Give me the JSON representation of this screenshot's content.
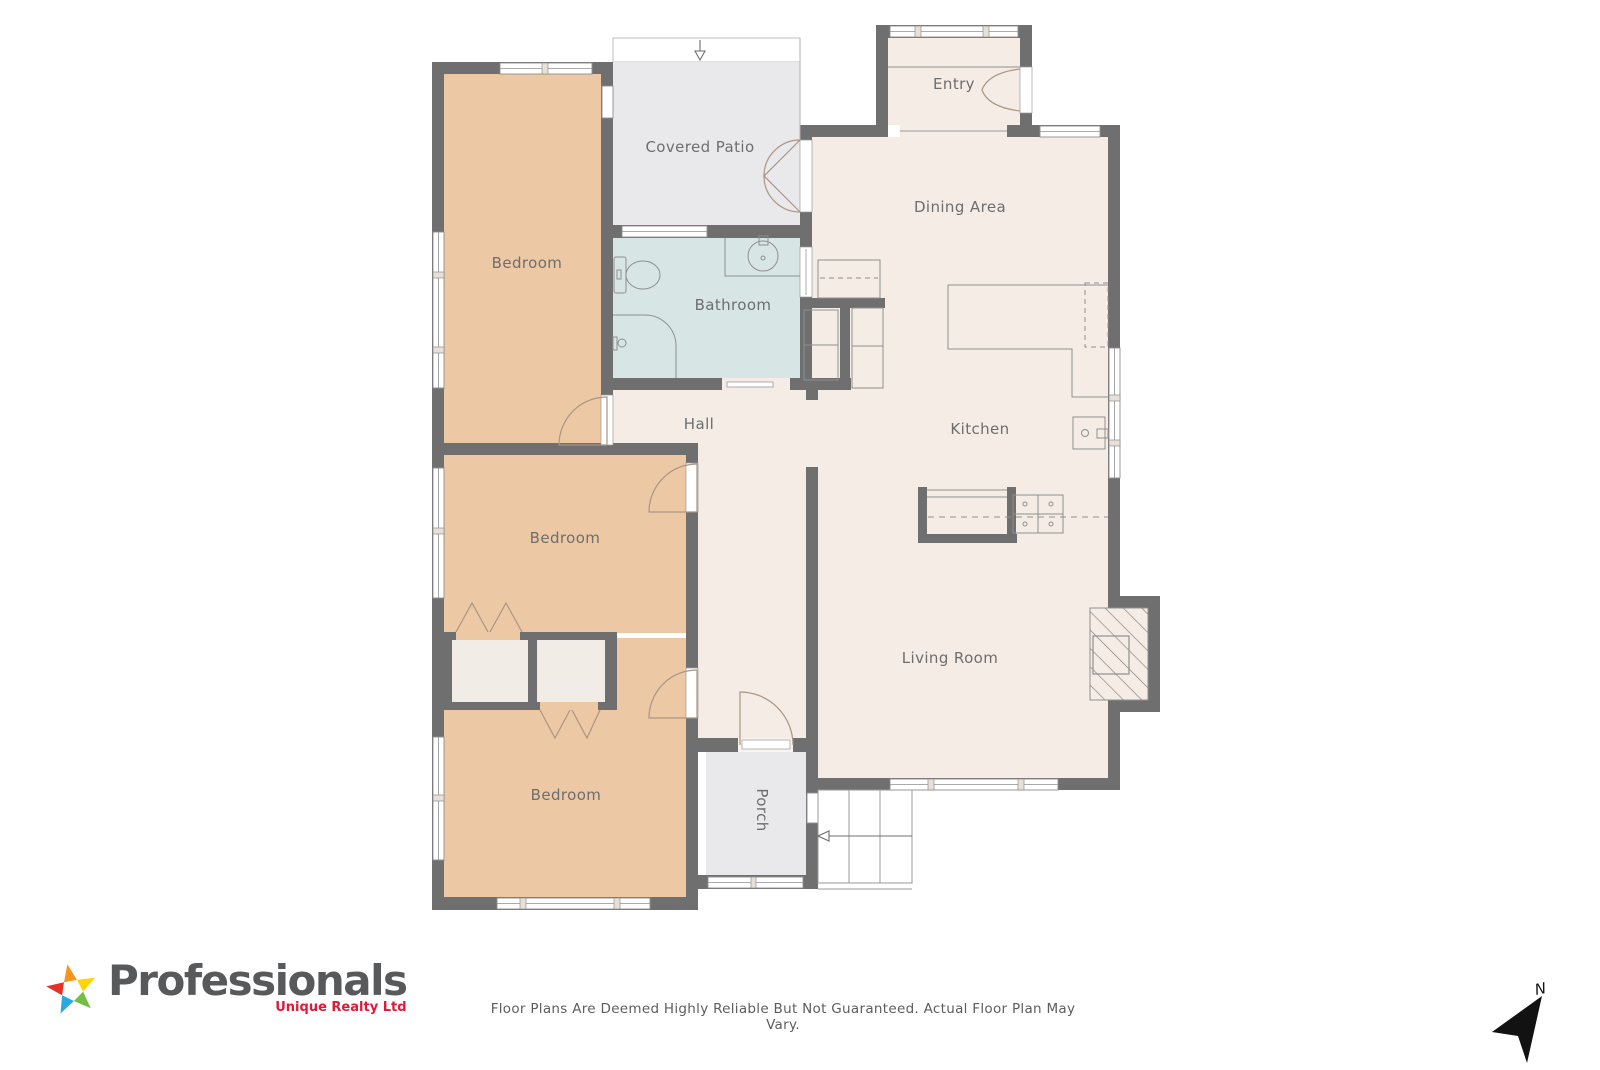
{
  "floor_plan": {
    "labels": {
      "covered_patio": "Covered Patio",
      "entry": "Entry",
      "dining_area": "Dining Area",
      "bedroom_top": "Bedroom",
      "bathroom": "Bathroom",
      "hall": "Hall",
      "kitchen": "Kitchen",
      "bedroom_middle": "Bedroom",
      "living_room": "Living Room",
      "bedroom_bottom": "Bedroom",
      "porch": "Porch"
    },
    "colors": {
      "wall": "#6f6f6f",
      "bedroom_fill": "#ecc8a5",
      "common_fill": "#f4ece5",
      "outdoor_fill": "#e9e9eb",
      "bathroom_fill": "#d7e5e4",
      "closet_fill": "#f1ece6",
      "thin_line": "#9a9a9a",
      "label_text": "#6e6e6e"
    }
  },
  "compass": {
    "north_label": "N"
  },
  "footer": {
    "brand": {
      "name": "Professionals",
      "tagline": "Unique Realty Ltd",
      "name_color": "#58595b",
      "tagline_color": "#e31837",
      "star_colors": [
        "#f7941d",
        "#e63128",
        "#29abe2",
        "#72bf44",
        "#ffd400"
      ]
    },
    "disclaimer": "Floor Plans Are Deemed Highly Reliable But Not Guaranteed. Actual Floor Plan May Vary."
  }
}
